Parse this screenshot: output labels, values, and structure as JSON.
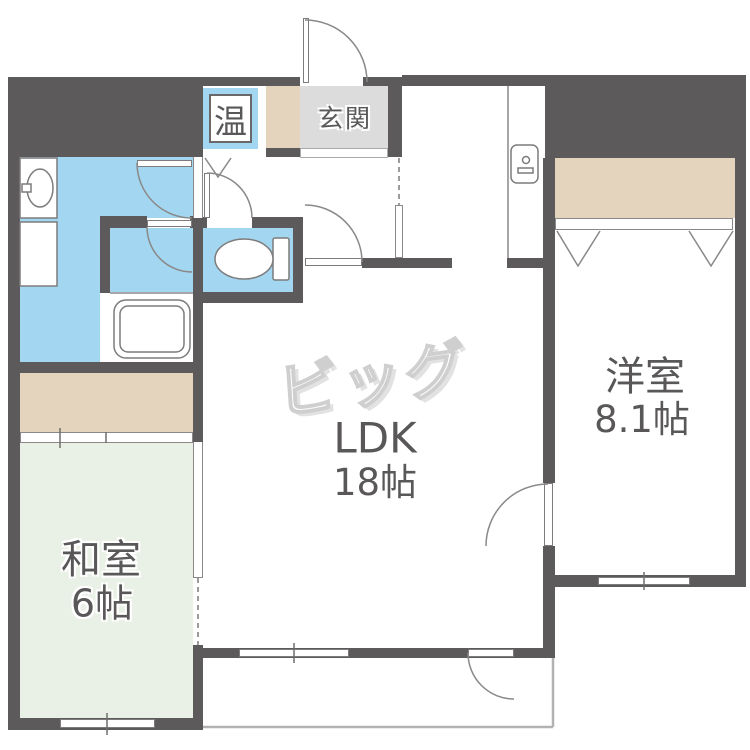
{
  "plan": {
    "title": "apartment-floor-plan",
    "watermark": "ビッグ",
    "colors": {
      "wall": "#5c5a5a",
      "water": "#a3d6f1",
      "tatami": "#e9f0e5",
      "closet": "#e5d4bd",
      "entry": "#dcdcdc",
      "text": "#595757"
    },
    "rooms": {
      "ldk": {
        "name": "LDK",
        "size": "18帖"
      },
      "western": {
        "name": "洋室",
        "size": "8.1帖"
      },
      "japanese": {
        "name": "和室",
        "size": "6帖"
      },
      "entrance": {
        "name": "玄関"
      },
      "water_heater": {
        "name": "温"
      }
    },
    "fixtures": [
      "bathtub",
      "toilet",
      "wash-basin",
      "laundry-pan",
      "utility-door-plate",
      "entrance-door",
      "closet-folding-doors",
      "sliding-door",
      "balcony"
    ]
  }
}
